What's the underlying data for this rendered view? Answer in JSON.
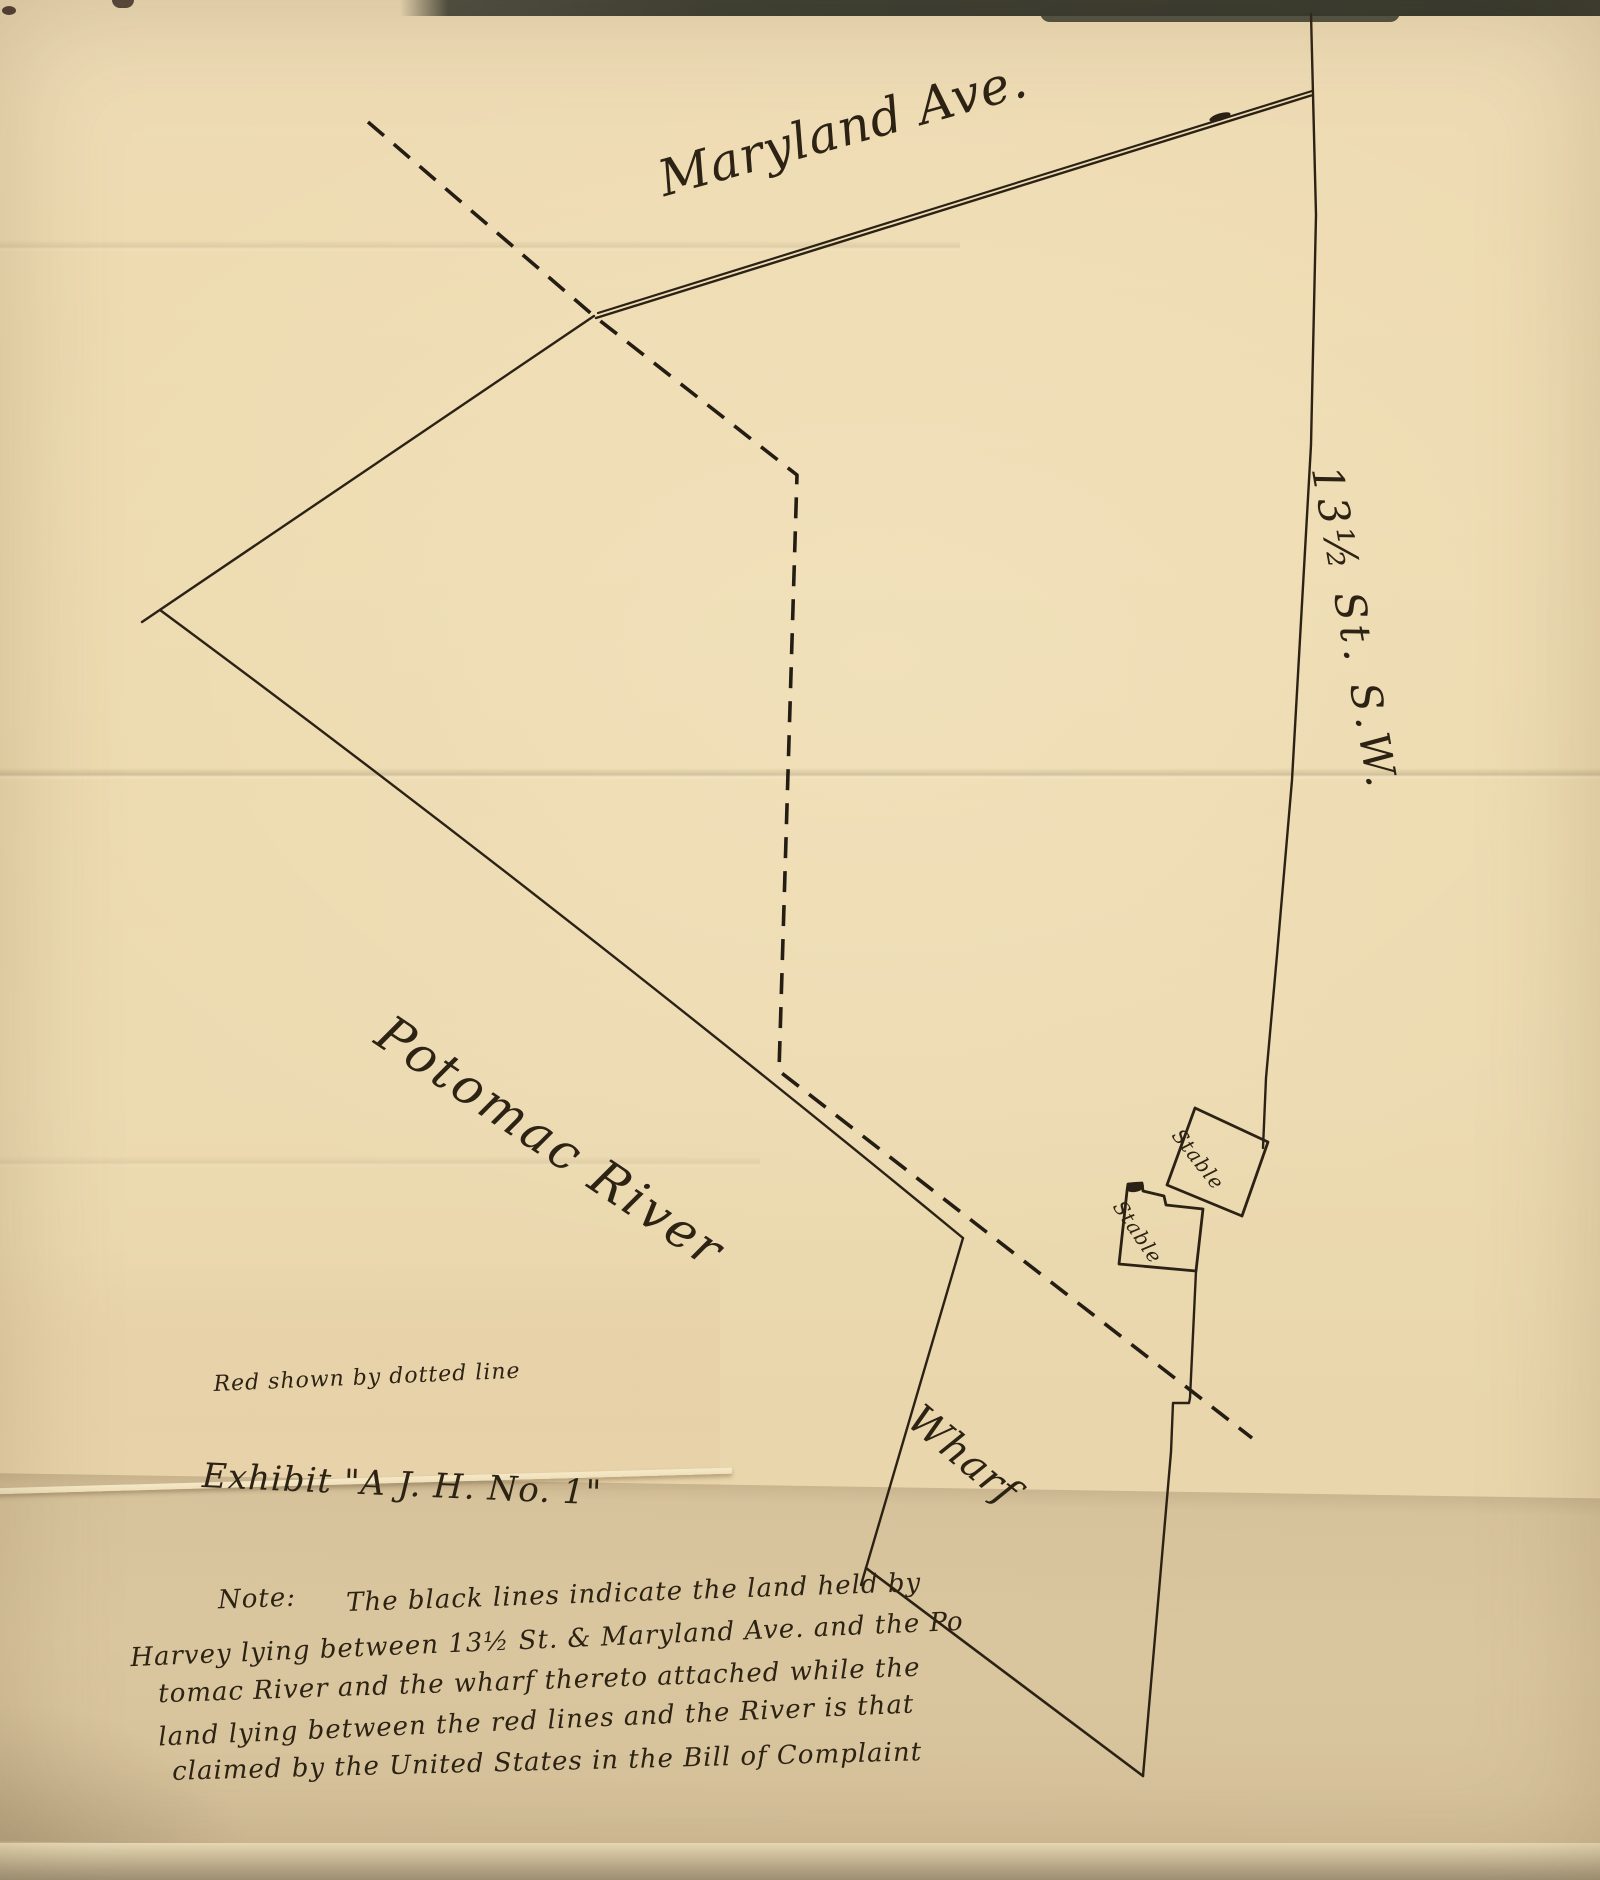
{
  "map": {
    "street_labels": {
      "avenue": "Maryland Ave.",
      "cross_street": "13½ St. S.W."
    },
    "water_label": "Potomac River",
    "building_labels": {
      "stable_upper": "Stable",
      "stable_lower": "Stable"
    },
    "wharf_label": "Wharf",
    "legend_note": "Red shown by dotted line",
    "exhibit_caption": "Exhibit \"A J. H. No. 1\"",
    "note": {
      "label": "Note:",
      "lines": [
        "The black lines indicate the land held by",
        "Harvey lying between 13½ St. & Maryland Ave. and the Po",
        "tomac River and the wharf thereto attached while the",
        "land lying between the red lines and the River is that",
        "claimed by the United States in the Bill of Complaint"
      ]
    },
    "colors": {
      "ink": "#2b2215",
      "dashed_line_ink": "#241d13",
      "paper": "#ecdab1",
      "fold_shadow": "#d9c7a3",
      "scan_edge": "#383b31"
    }
  }
}
